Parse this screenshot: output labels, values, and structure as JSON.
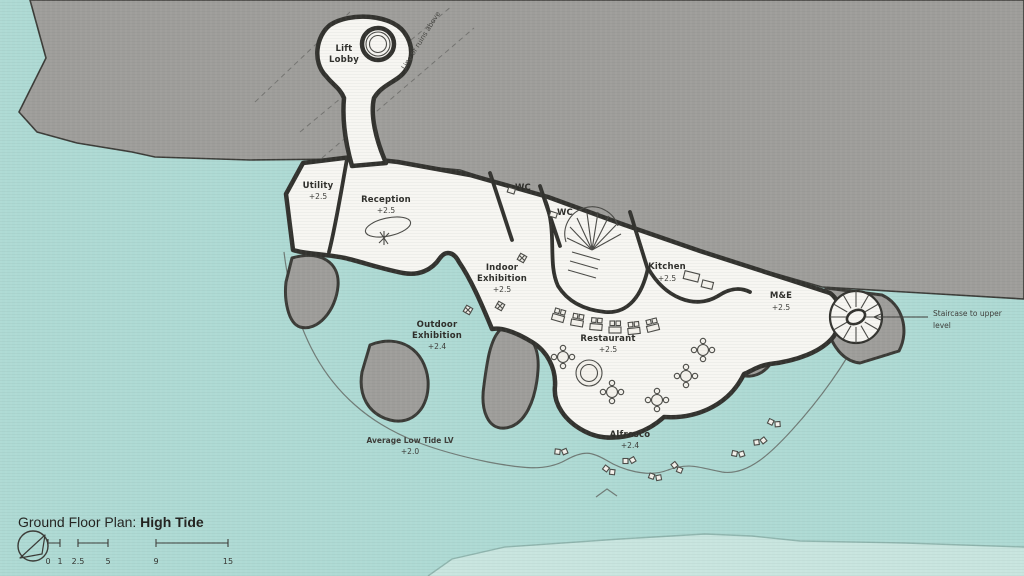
{
  "title": {
    "label": "Ground Floor Plan: ",
    "highlight": "High Tide"
  },
  "plan": {
    "rooms": {
      "lift_lobby": {
        "line1": "Lift",
        "line2": "Lobby"
      },
      "utility": {
        "name": "Utility",
        "level": "+2.5"
      },
      "reception": {
        "name": "Reception",
        "level": "+2.5"
      },
      "wc_1": {
        "name": "WC"
      },
      "wc_2": {
        "name": "WC"
      },
      "indoor_exhibition": {
        "line1": "Indoor",
        "line2": "Exhibition",
        "level": "+2.5"
      },
      "kitchen": {
        "name": "Kitchen",
        "level": "+2.5"
      },
      "m_and_e": {
        "name": "M&E",
        "level": "+2.5"
      },
      "restaurant": {
        "name": "Restaurant",
        "level": "+2.5"
      },
      "outdoor_exhibition": {
        "line1": "Outdoor",
        "line2": "Exhibition",
        "level": "+2.4"
      },
      "alfresco": {
        "name": "Alfresco",
        "level": "+2.4"
      }
    },
    "annotations": {
      "roof_line": "Line of ruins above",
      "staircase_line1": "Staircase to upper",
      "staircase_line2": "level",
      "tide_name": "Average Low Tide LV",
      "tide_level": "+2.0"
    }
  },
  "scalebar": {
    "ticks": [
      "0",
      "1",
      "2.5",
      "5",
      "9",
      "15"
    ]
  },
  "colors": {
    "water": "#aedad4",
    "low_tide": "#c8e5df",
    "land": "#9e9d9a",
    "floor": "#f7f6f2",
    "ink": "#32322e"
  }
}
